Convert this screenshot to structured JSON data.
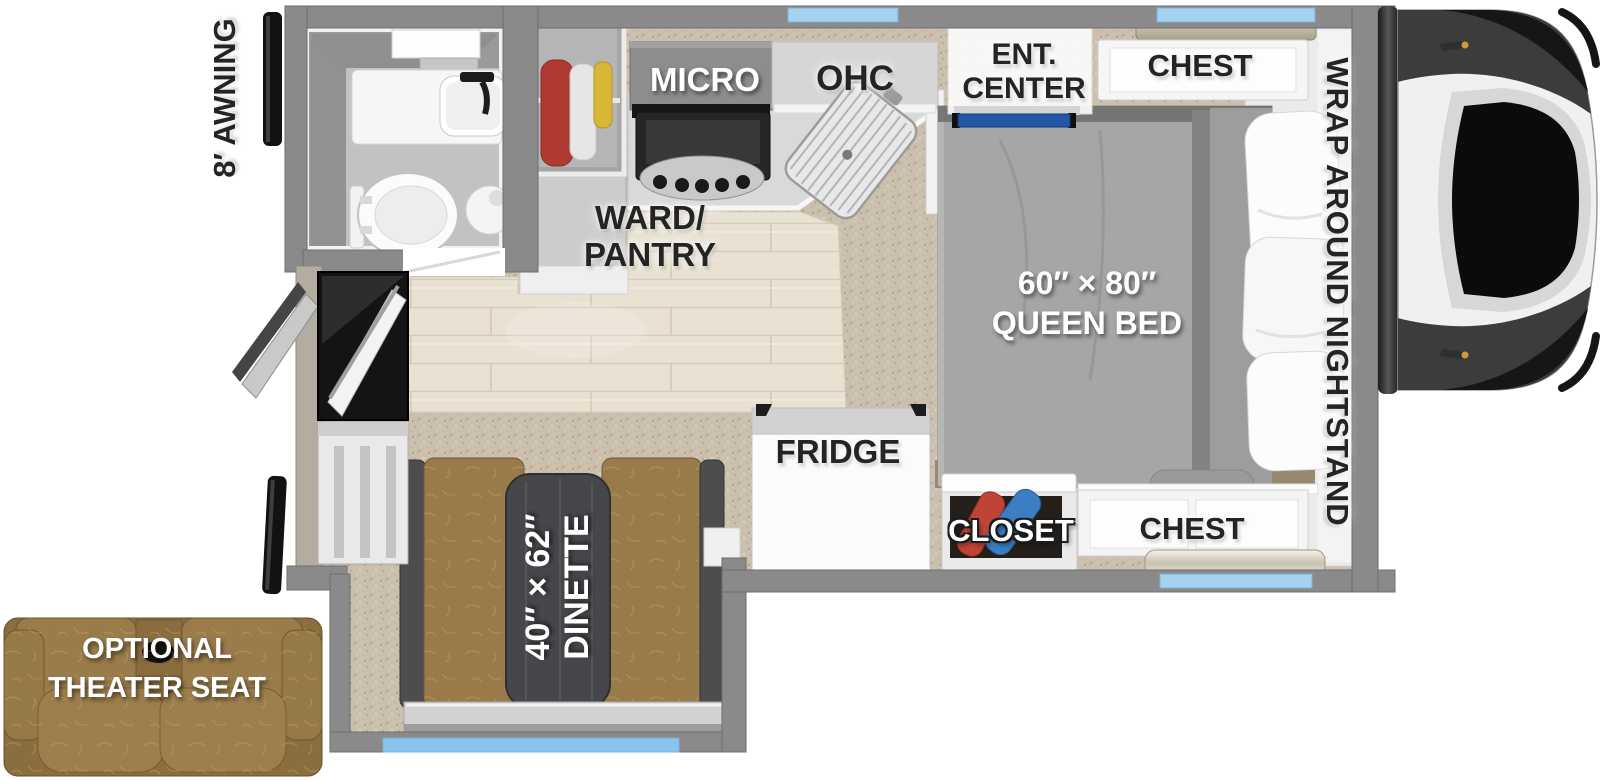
{
  "title": "Truck camper floor plan",
  "labels": {
    "awning": "8′ AWNING",
    "micro": "MICRO",
    "ohc": "OHC",
    "ent_center": {
      "line1": "ENT.",
      "line2": "CENTER"
    },
    "chest_bedroom_top": "CHEST",
    "wrap_nightstand": "WRAP AROUND NIGHTSTAND",
    "ward_pantry": {
      "line1": "WARD/",
      "line2": "PANTRY"
    },
    "queen_bed": {
      "line1": "60″ × 80″",
      "line2": "QUEEN BED"
    },
    "fridge": "FRIDGE",
    "closet": "CLOSET",
    "chest_bedroom_bottom": "CHEST",
    "dinette": {
      "line1": "40″ × 62″",
      "line2": "DINETTE"
    },
    "theater_seat": {
      "line1": "OPTIONAL",
      "line2": "THEATER SEAT"
    }
  },
  "colors": {
    "wall_gray": "#8A8A8A",
    "window_blue": "#A5D2EE",
    "dinette_window_blue": "#88C4EC",
    "carpet_beige": "#CBBFAE",
    "wood_floor": "#E9E2D3",
    "bed_gray": "#A6A6A6",
    "leather_brown": "#997B4B",
    "table_charcoal": "#46474A",
    "closet_red": "#BF4337",
    "closet_blue": "#3B7EC2",
    "hanger_red": "#AE3A31",
    "hanger_yellow": "#D8B737",
    "accent_blue_strip": "#2356A5",
    "label_dark": "#242424",
    "label_light": "#FFFFFF"
  }
}
